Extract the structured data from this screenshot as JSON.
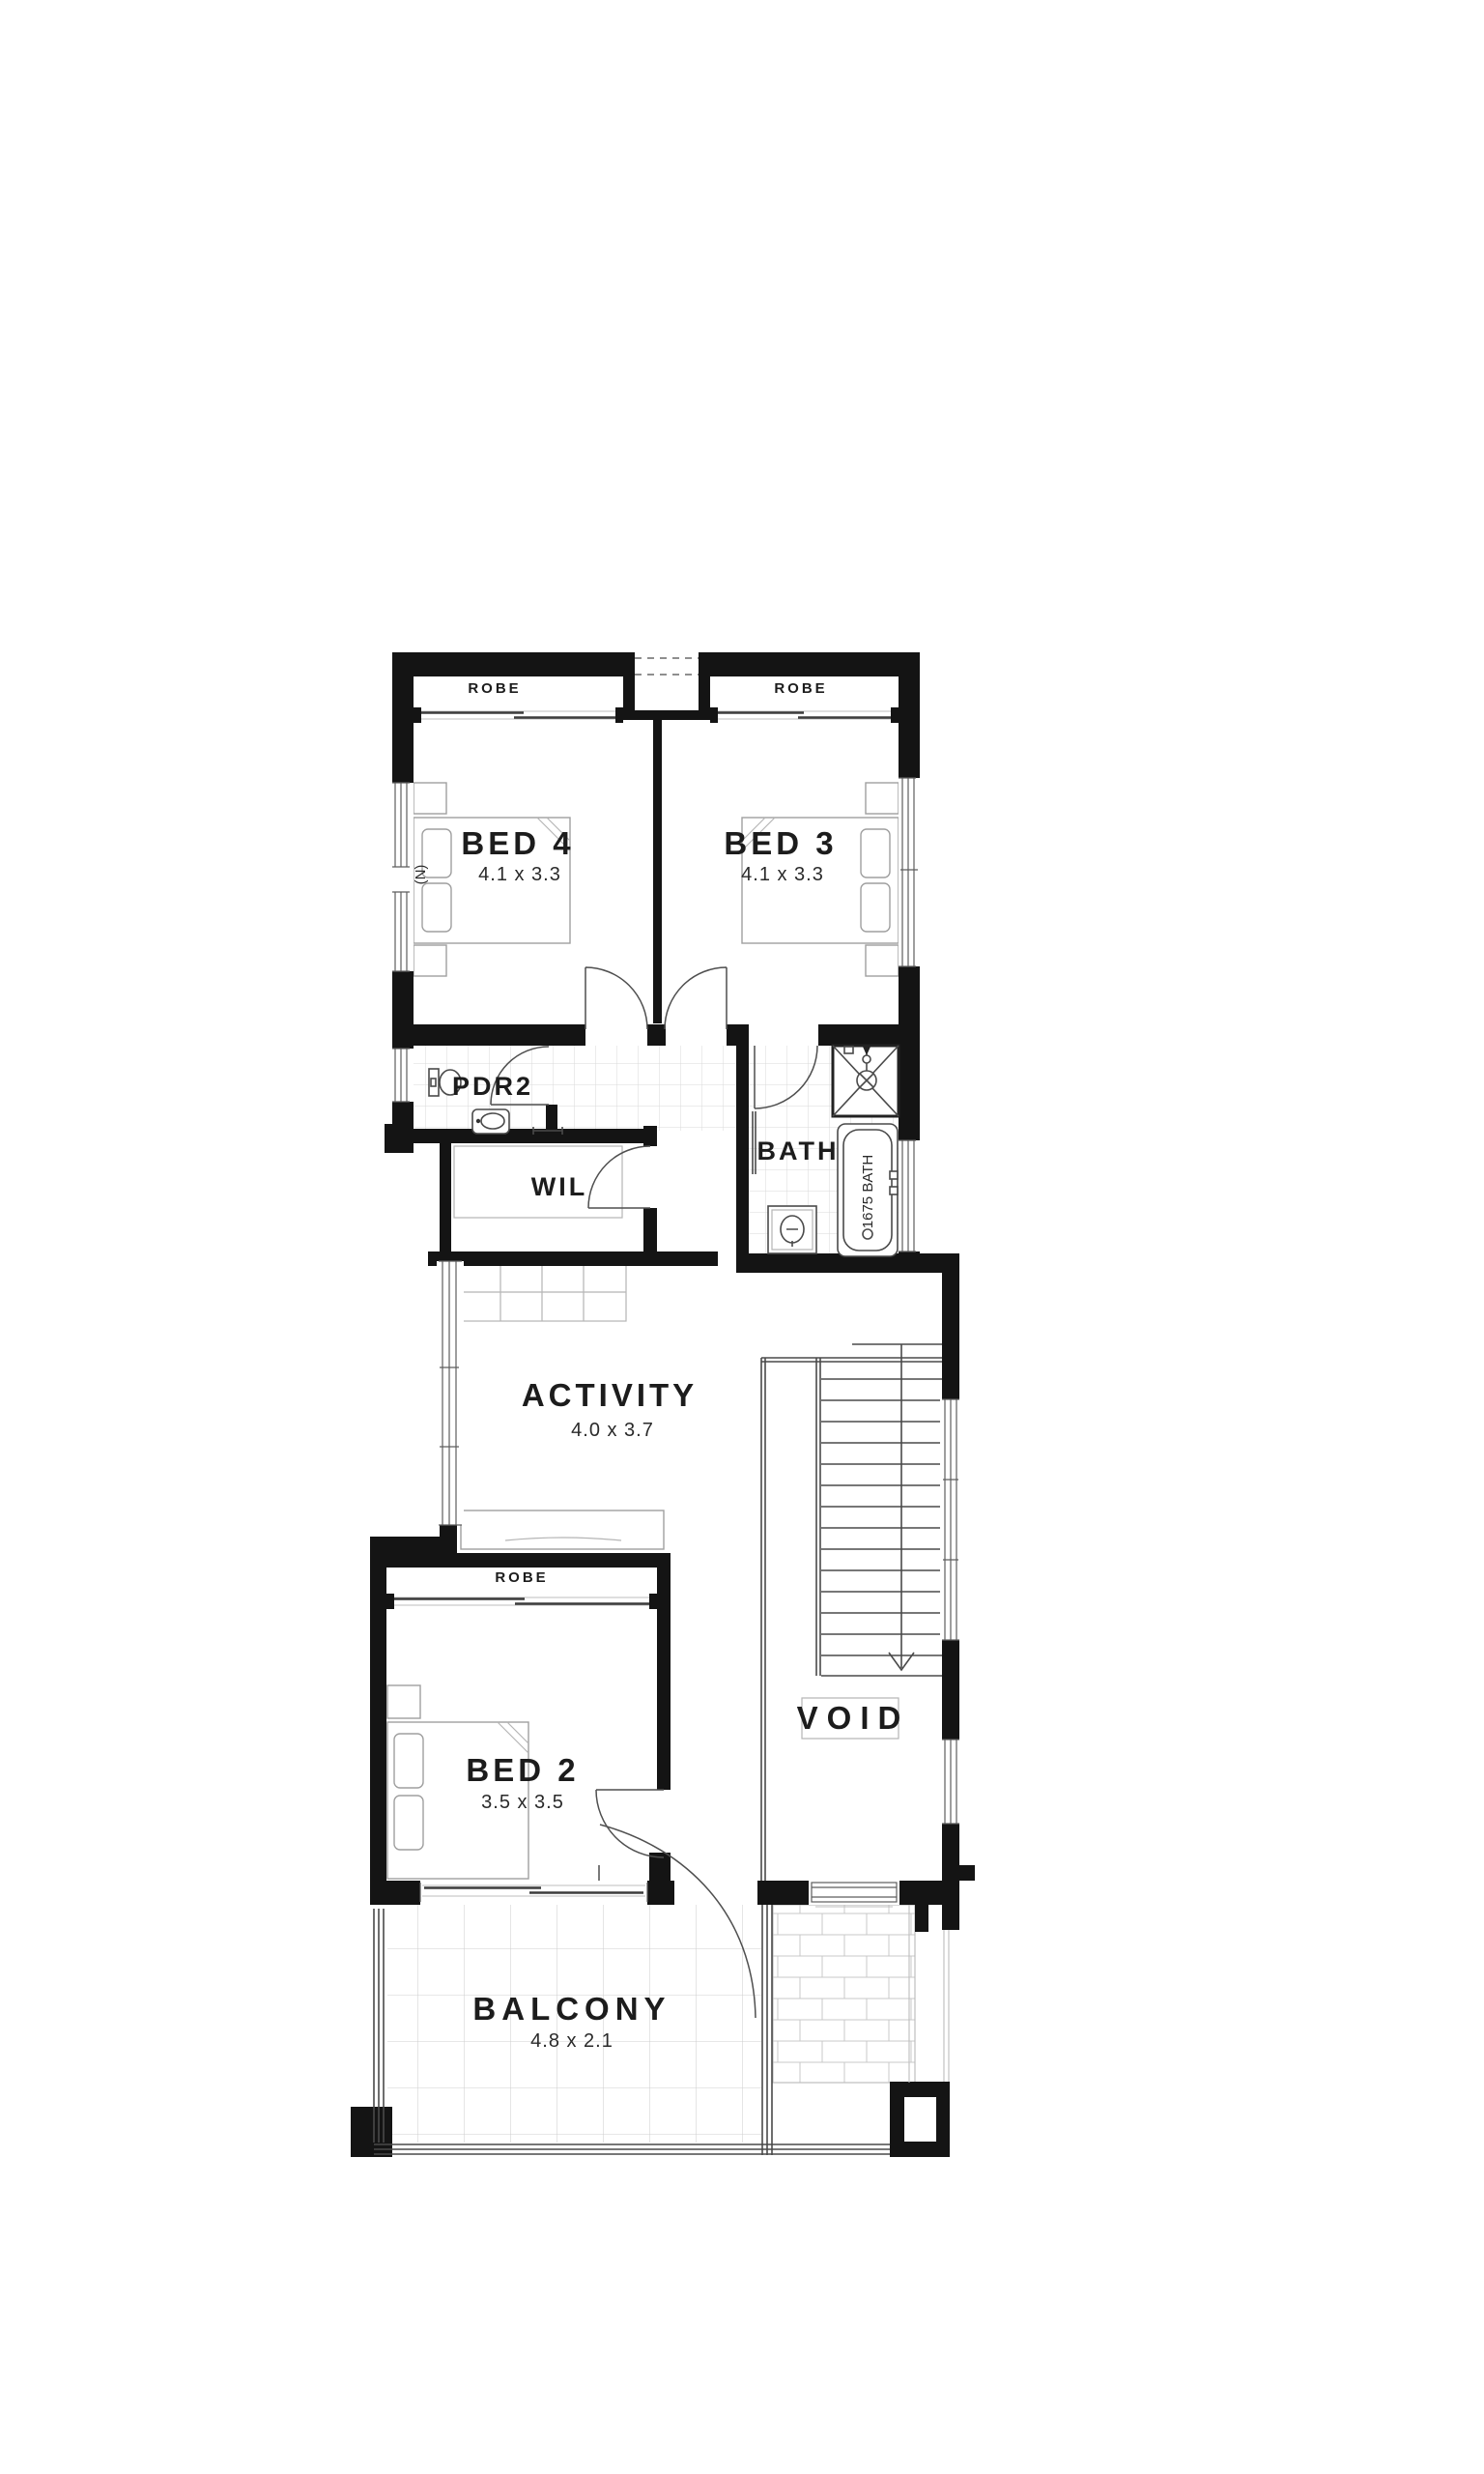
{
  "plan": {
    "rooms": {
      "bed4": {
        "label": "BED 4",
        "dims": "4.1 x 3.3"
      },
      "bed3": {
        "label": "BED 3",
        "dims": "4.1 x 3.3"
      },
      "bed2": {
        "label": "BED 2",
        "dims": "3.5 x 3.5"
      },
      "activity": {
        "label": "ACTIVITY",
        "dims": "4.0 x 3.7"
      },
      "balcony": {
        "label": "BALCONY",
        "dims": "4.8 x 2.1"
      },
      "pdr2": {
        "label": "PDR2"
      },
      "wil": {
        "label": "WIL"
      },
      "bath": {
        "label": "BATH"
      },
      "void": {
        "label": "VOID"
      }
    },
    "robes": {
      "bed4": "ROBE",
      "bed3": "ROBE",
      "bed2": "ROBE"
    },
    "annotations": {
      "bath_tub": "1675 BATH",
      "north": "(N)"
    },
    "colors": {
      "wall": "#141414",
      "line": "#4a4a4a",
      "tile": "#d9d9d9",
      "paper": "#ffffff"
    }
  }
}
